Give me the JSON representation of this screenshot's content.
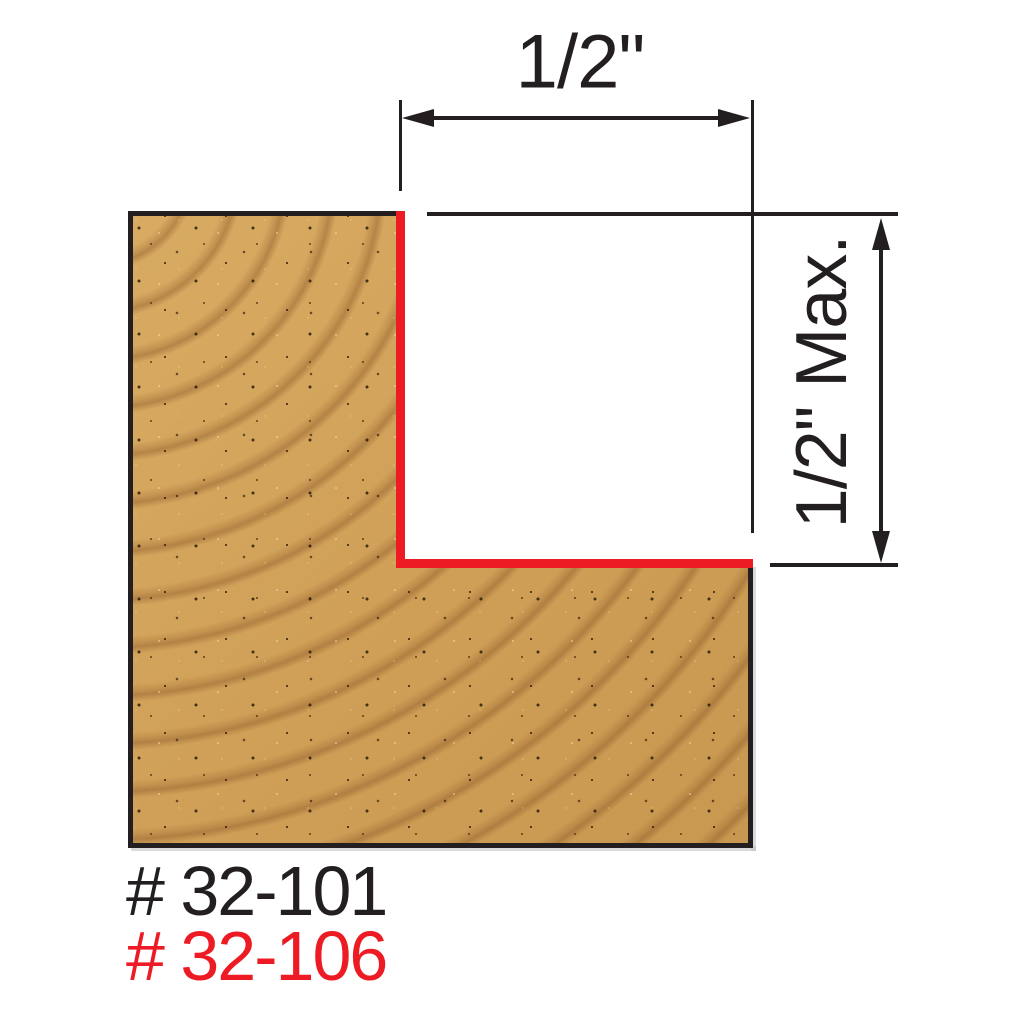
{
  "diagram": {
    "background": "#ffffff",
    "line_color": "#231f20",
    "accent_red": "#ed1c24",
    "wood_colors": {
      "base": "#d0a058",
      "ring": "#9a6630",
      "speckle": "#2e1c08"
    },
    "dimensions": {
      "width": {
        "label": "1/2\""
      },
      "depth": {
        "label": "1/2\" Max."
      }
    },
    "part_numbers": [
      {
        "text": "# 32-101",
        "color": "#231f20"
      },
      {
        "text": "# 32-106",
        "color": "#ed1c24"
      }
    ]
  }
}
